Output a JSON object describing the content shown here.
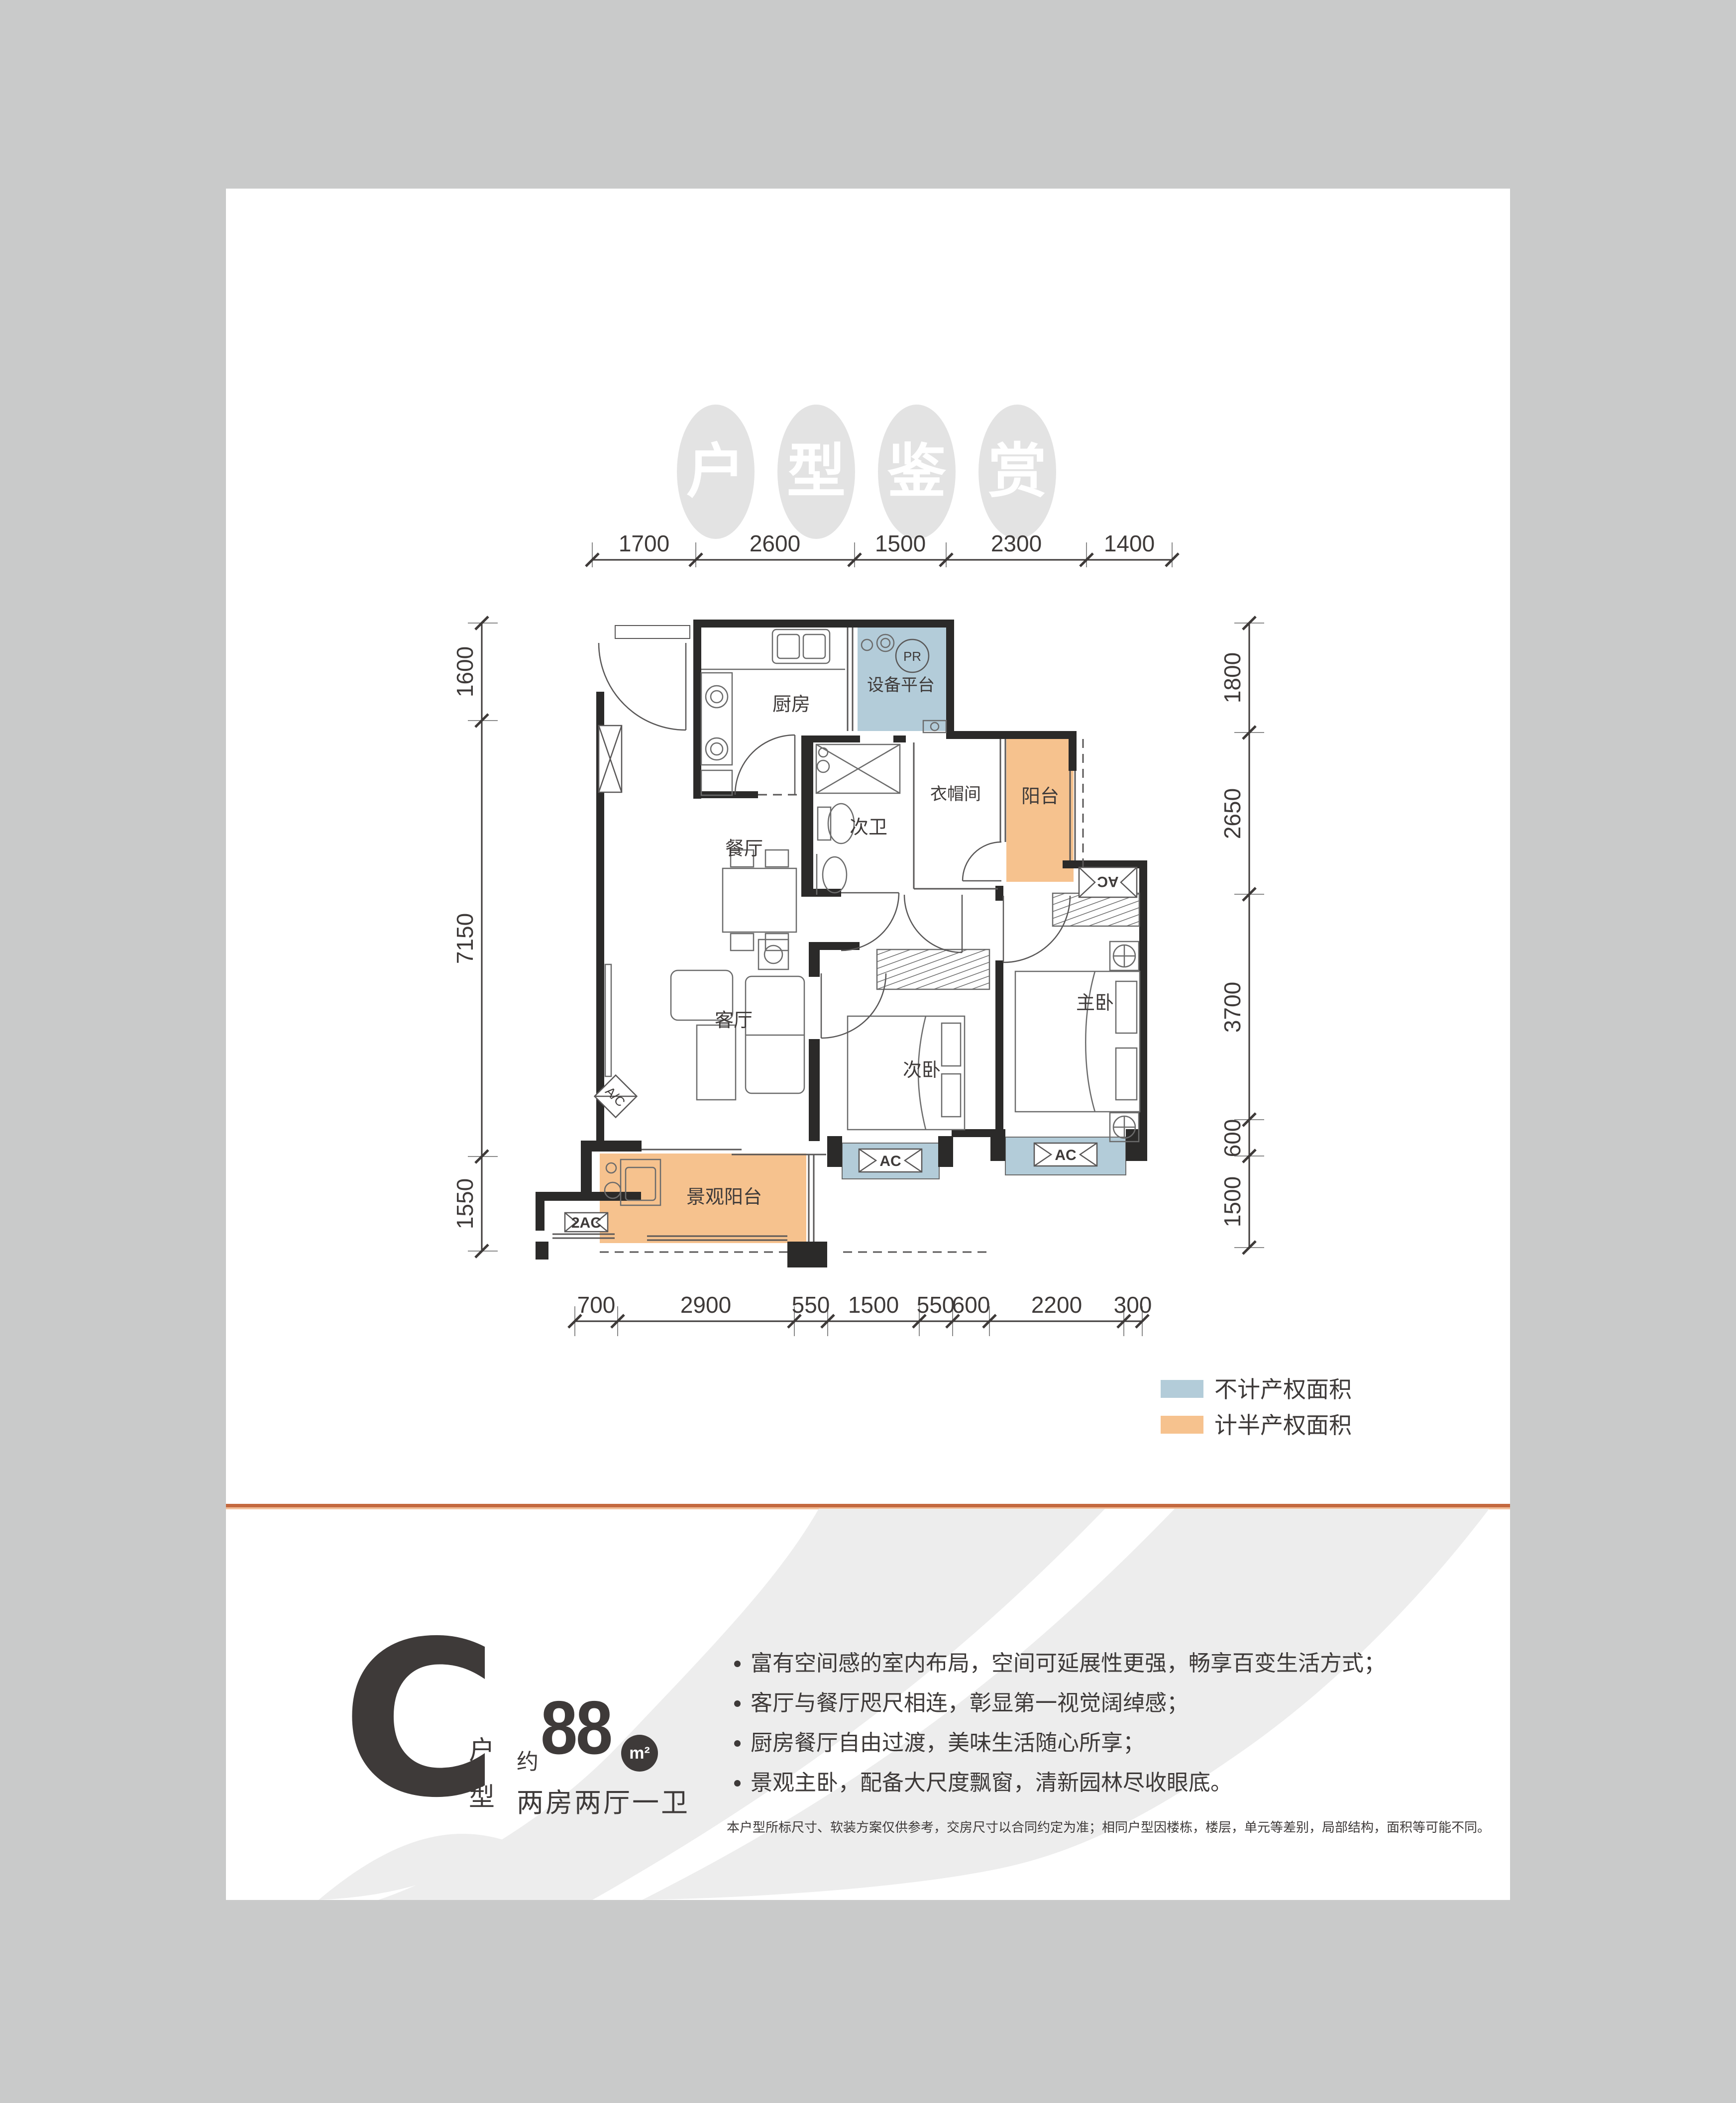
{
  "title": {
    "chars": [
      "户",
      "型",
      "鉴",
      "赏"
    ]
  },
  "plan": {
    "rooms": {
      "kitchen": "厨房",
      "equipment": "设备平台",
      "cloakroom": "衣帽间",
      "balcony": "阳台",
      "dining": "餐厅",
      "bath2": "次卫",
      "living": "客厅",
      "bed2": "次卧",
      "master": "主卧",
      "view_balcony": "景观阳台"
    },
    "marks": {
      "pr": "PR",
      "ac": "AC",
      "ac2": "2AC",
      "acd": "A/C"
    },
    "dims": {
      "top": [
        "1700",
        "2600",
        "1500",
        "2300",
        "1400"
      ],
      "bottom": [
        "700",
        "2900",
        "550",
        "1500",
        "550",
        "600",
        "2200",
        "300"
      ],
      "left": [
        "1600",
        "7150",
        "1550"
      ],
      "right": [
        "1800",
        "2650",
        "3700",
        "600",
        "1500"
      ]
    }
  },
  "legend": {
    "no_property": {
      "label": "不计产权面积",
      "color": "#b3ccd9"
    },
    "half_property": {
      "label": "计半产权面积",
      "color": "#f6c28e"
    }
  },
  "info": {
    "type_letter": "C",
    "type_word": [
      "户",
      "型"
    ],
    "approx_prefix": "约",
    "area_value": "88",
    "area_unit": "m²",
    "layout_summary": "两房两厅一卫",
    "bullets": [
      "富有空间感的室内布局，空间可延展性更强，畅享百变生活方式；",
      "客厅与餐厅咫尺相连，彰显第一视觉阔绰感；",
      "厨房餐厅自由过渡，美味生活随心所享；",
      "景观主卧，配备大尺度飘窗，清新园林尽收眼底。"
    ],
    "disclaimer": "本户型所标尺寸、软装方案仅供参考，交房尺寸以合同约定为准；相同户型因楼栋，楼层，单元等差别，局部结构，面积等可能不同。"
  },
  "colors": {
    "background": "#c9caca",
    "card": "#ffffff",
    "wall": "#2b2a29",
    "no_property_area": "#b3ccd9",
    "half_property_area": "#f6c28e",
    "divider": "#c4693f",
    "swoosh": "#ededed",
    "text": "#3e3a39"
  }
}
